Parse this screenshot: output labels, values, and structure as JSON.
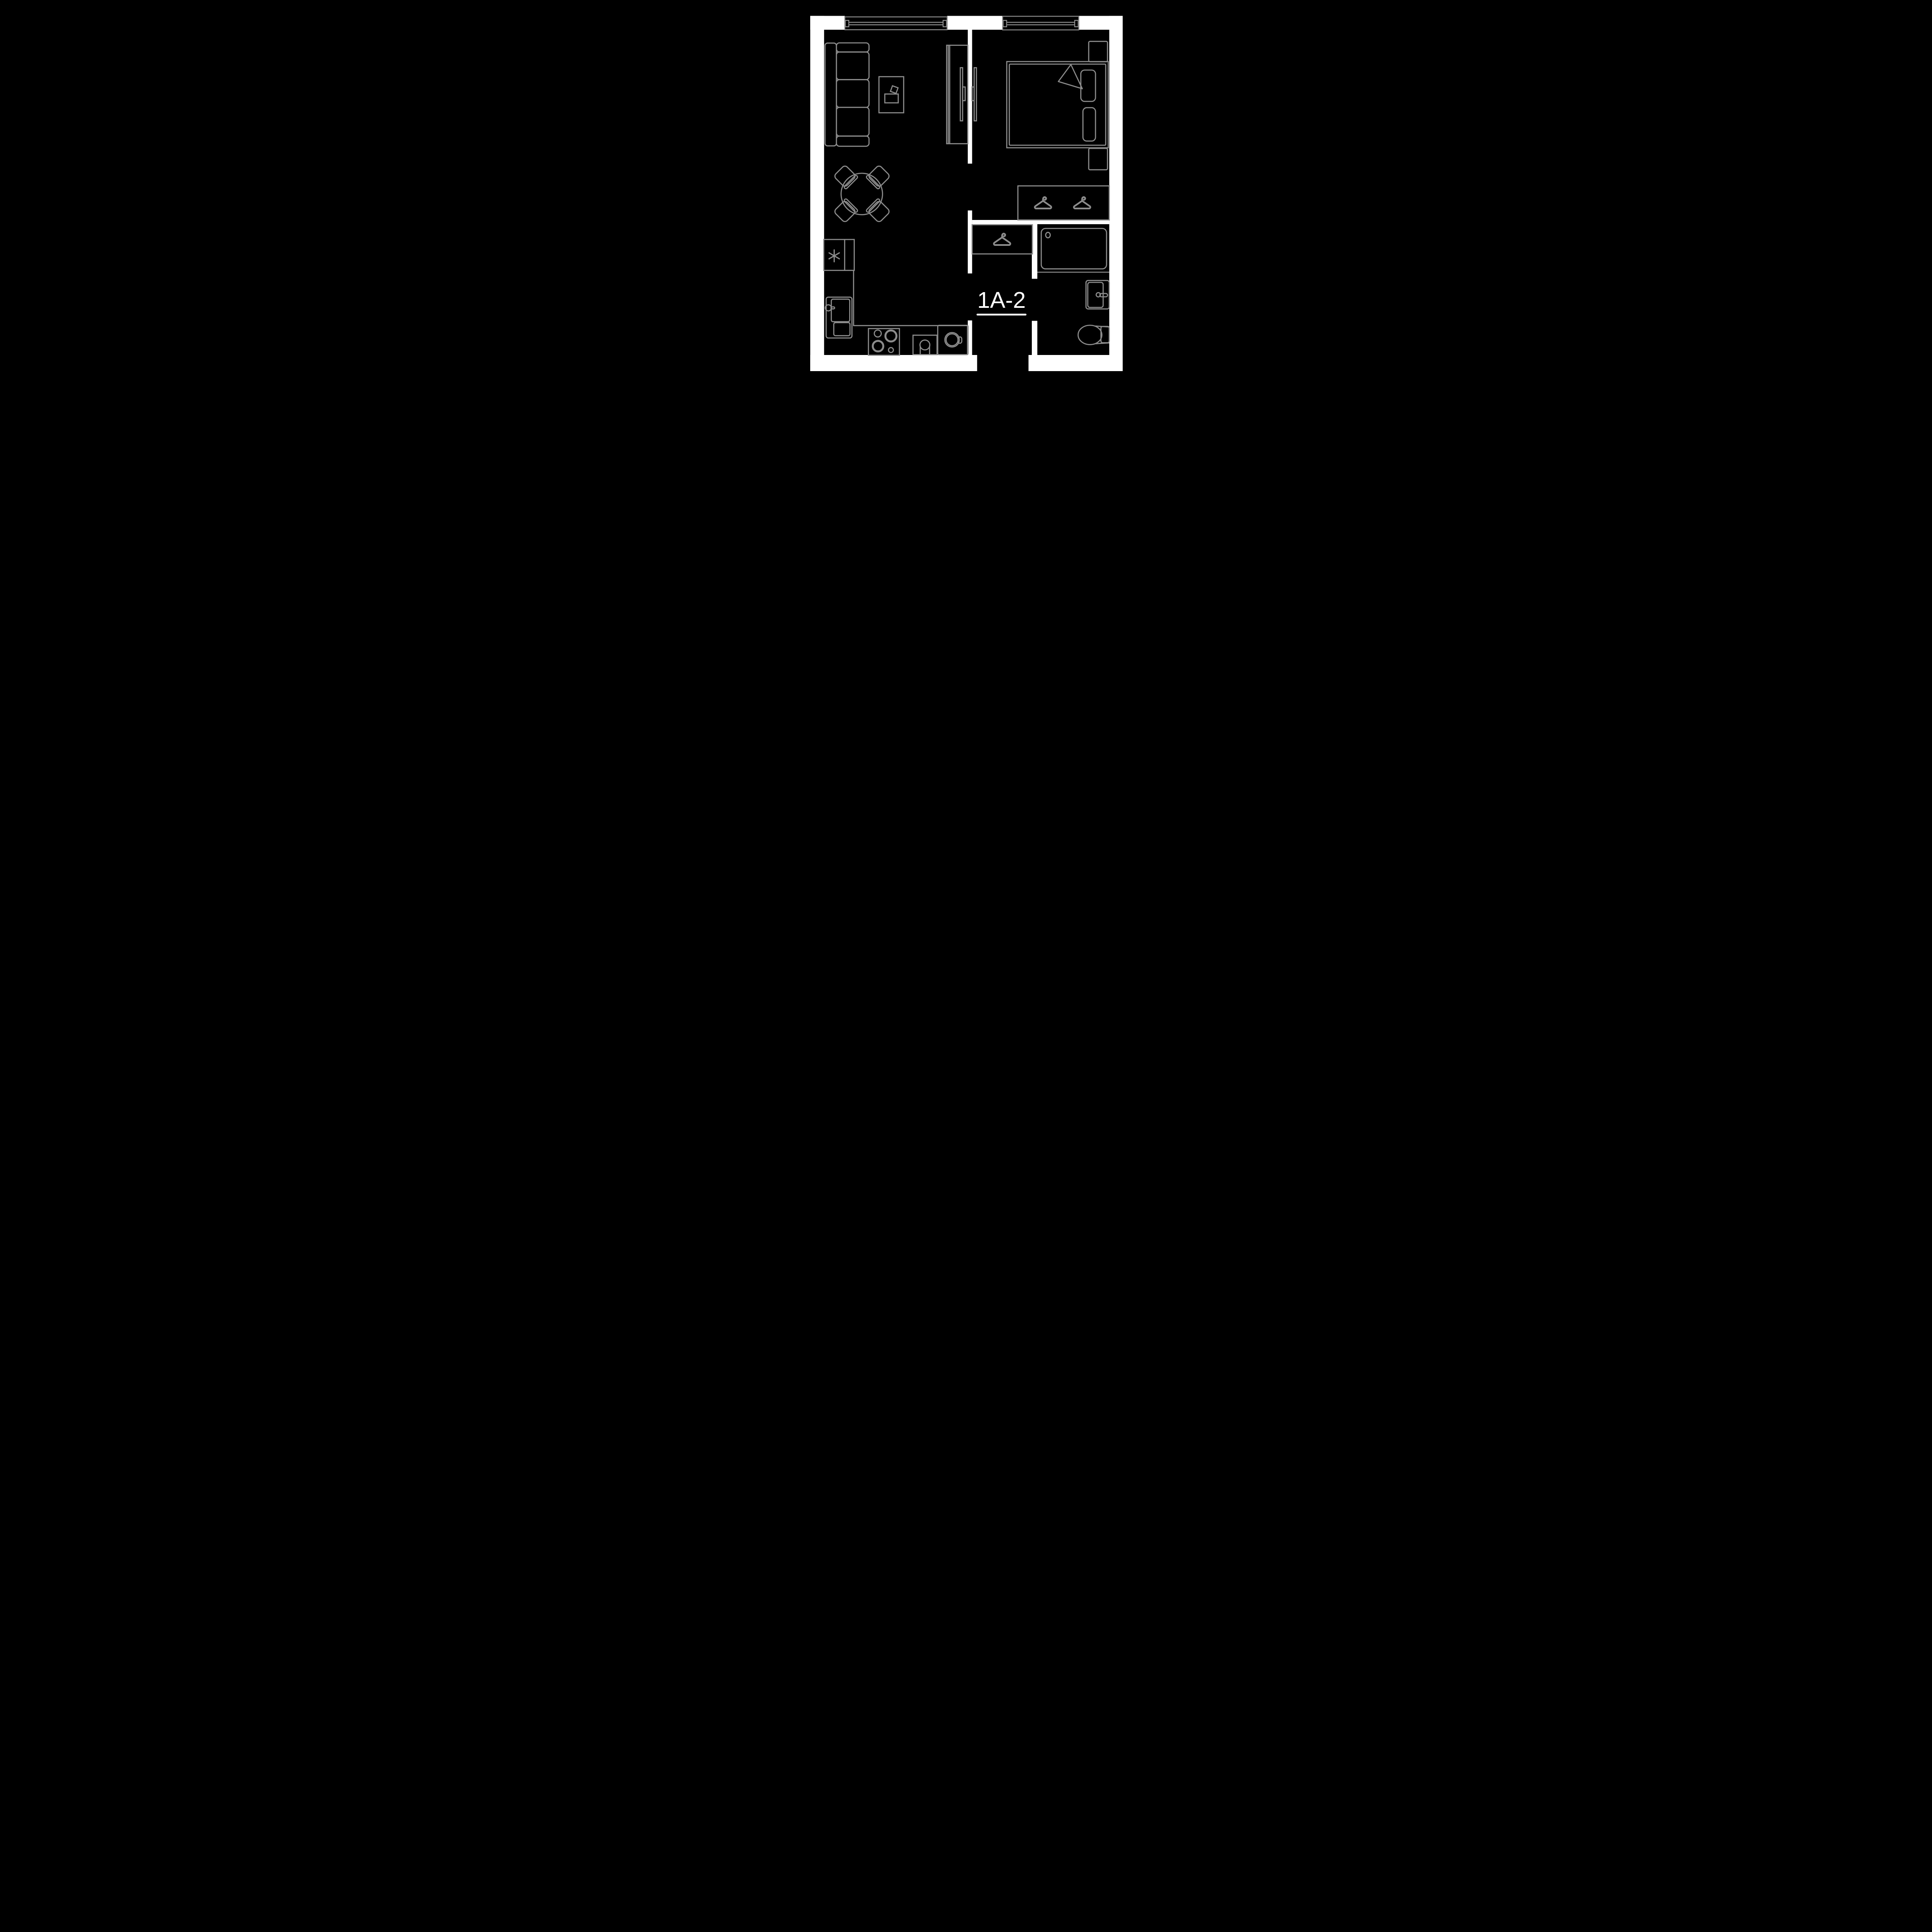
{
  "plan": {
    "unit_label": "1A-2",
    "colors": {
      "background": "#000000",
      "walls": "#ffffff",
      "furniture_outline": "#8d8d8d",
      "label_text": "#ffffff"
    },
    "windows_count": 2,
    "door_openings": [
      "entry",
      "living-room",
      "bedroom",
      "bathroom"
    ],
    "icons": {
      "fridge": "asterisk-icon",
      "closets": "hanger-icon"
    },
    "furniture_visible": [
      "sofa",
      "coffee-table",
      "round-dining-table",
      "dining-chair x4",
      "tv-wardrobe-unit",
      "wall-tv x2",
      "refrigerator",
      "kitchen-sink-cabinet",
      "cooktop-4-burners",
      "small-sink",
      "washing-machine",
      "double-bed",
      "pillow x2",
      "blanket-fold",
      "nightstand x2",
      "bedroom-wardrobe (2 hangers)",
      "hallway-closet (1 hanger)",
      "bathtub",
      "washbasin",
      "toilet"
    ]
  }
}
